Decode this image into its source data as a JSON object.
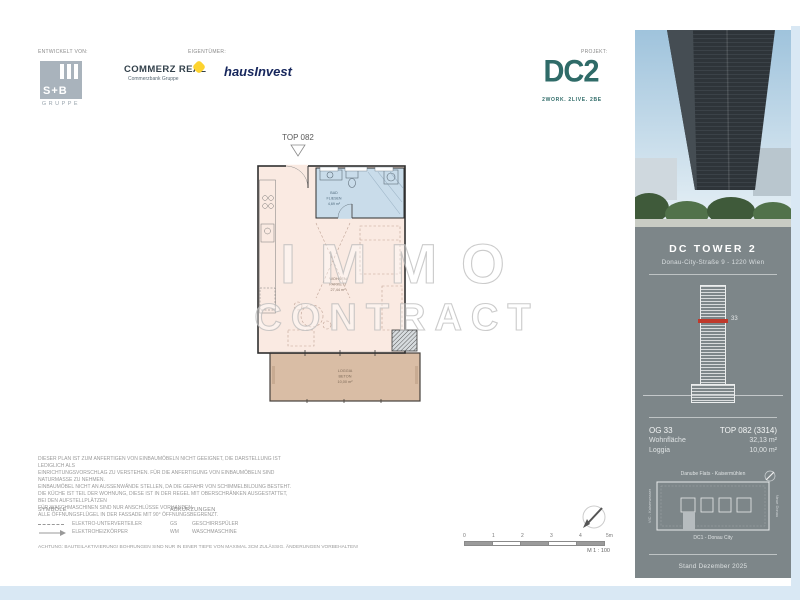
{
  "header": {
    "developed_by_label": "ENTWICKELT VON:",
    "owner_label": "EIGENTÜMER:",
    "project_label": "PROJEKT:"
  },
  "logos": {
    "sb": {
      "name": "S+B",
      "sub": "GRUPPE"
    },
    "commerz_real": {
      "name": "COMMERZ REAL",
      "sub": "Commerzbank Gruppe"
    },
    "hausinvest": "hausInvest",
    "dc2": {
      "name": "DC2",
      "tagline": "2WORK. 2LIVE. 2BE"
    }
  },
  "plan": {
    "unit_label": "TOP 082",
    "bath": {
      "name": "BAD",
      "floor": "FLIESEN",
      "area": "4,69 m²"
    },
    "living": {
      "name": "WOHNEN",
      "floor": "PARKETT",
      "area": "27,44 m²"
    },
    "loggia": {
      "name": "LOGGIA",
      "floor": "BETON",
      "area": "10,00 m²"
    }
  },
  "watermark": {
    "line1": "IMMO",
    "line2": "CONTRACT"
  },
  "disclaimer": {
    "lines": [
      "DIESER PLAN IST ZUM ANFERTIGEN VON EINBAUMÖBELN NICHT GEEIGNET, DIE DARSTELLUNG IST LEDIGLICH ALS",
      "EINRICHTUNGSVORSCHLAG ZU VERSTEHEN. FÜR DIE ANFERTIGUNG VON EINBAUMÖBELN SIND NATURMASSE ZU NEHMEN.",
      "EINBAUMÖBEL NICHT AN AUSSENWÄNDE STELLEN, DA DIE GEFAHR VON SCHIMMELBILDUNG BESTEHT.",
      "DIE KÜCHE IST TEIL DER WOHNUNG, DIESE IST IN DER REGEL MIT OBERSCHRÄNKEN AUSGESTATTET, BEI DEN AUFSTELLPLÄTZEN",
      "FÜR WASCHMASCHINEN SIND NUR ANSCHLÜSSE VORHANDEN.",
      "ALLE ÖFFNUNGSFLÜGEL IN DER FASSADE MIT 90° ÖFFNUNGSBEGRENZT."
    ]
  },
  "legend": {
    "symbols_title": "SYMBOLE",
    "abbreviations_title": "ABKÜRZUNGEN",
    "symbol1": "ELEKTRO-UNTERVERTEILER",
    "symbol2": "ELEKTROHEIZKÖRPER",
    "abbr1_key": "GS",
    "abbr1_value": "GESCHIRRSPÜLER",
    "abbr2_key": "WM",
    "abbr2_value": "WASCHMASCHINE",
    "warning": "ACHTUNG: BAUTEILAKTIVIERUNG! BOHRUNGEN SIND NUR IN EINER TIEFE VON MAXIMAL 3CM ZULÄSSIG. ÄNDERUNGEN VORBEHALTEN!"
  },
  "scale": {
    "ticks": [
      "0",
      "1",
      "2",
      "3",
      "4",
      "5m"
    ],
    "label": "M 1 : 100"
  },
  "sidebar": {
    "building_name": "DC TOWER 2",
    "address": "Donau-City-Straße 9 - 1220 Wien",
    "floor_marker": "33",
    "unit_floor": "OG 33",
    "unit_top": "TOP 082 (3314)",
    "area_label": "Wohnfläche",
    "area_value": "32,13 m²",
    "loggia_label": "Loggia",
    "loggia_value": "10,00 m²",
    "siteplan": {
      "top": "Danube Flats - Kaisermühlen",
      "left": "VIC - Kaiserwasser",
      "right": "Neue Donau",
      "bottom": "DC1 - Donau City"
    },
    "version": "Stand Dezember 2025"
  },
  "colors": {
    "accent_teal": "#2f6b68",
    "commerzbank_yellow": "#fdd32f",
    "hausinvest_navy": "#16265c",
    "panel_gray": "#7d8689",
    "room_fill": "#faeae2",
    "bath_fill": "#c9dcea",
    "loggia_fill": "#d9bda5",
    "floor_marker_red": "#c0392b",
    "frame_blue": "#d9e8f4"
  }
}
